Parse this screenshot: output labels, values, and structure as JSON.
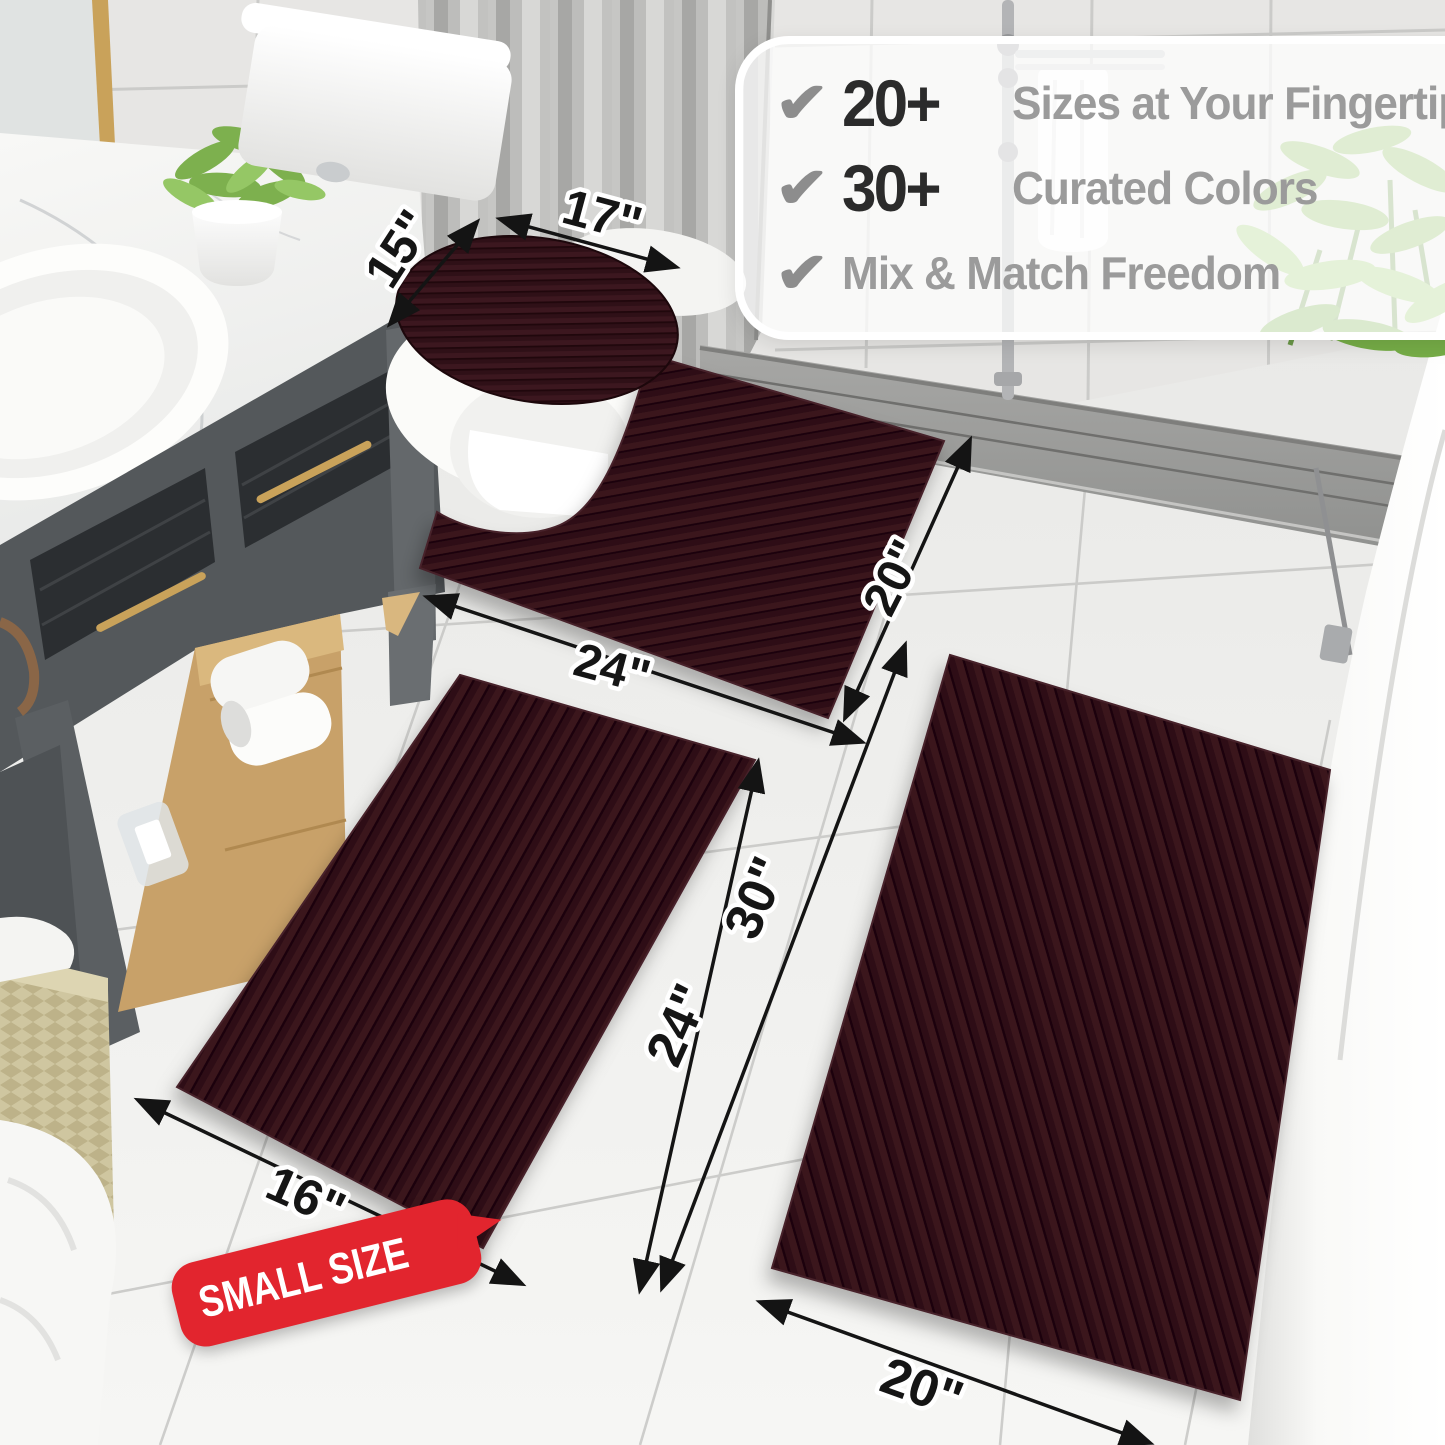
{
  "callout": {
    "items": [
      {
        "icon": "check-icon",
        "glyph": "✔",
        "value": "20+",
        "label": "Sizes at Your Fingertips"
      },
      {
        "icon": "check-icon",
        "glyph": "✔",
        "value": "30+",
        "label": "Curated Colors"
      },
      {
        "icon": "check-icon",
        "glyph": "✔",
        "value": "",
        "label": "Mix & Match Freedom"
      }
    ]
  },
  "dimensions": {
    "lid_cover_width": "17\"",
    "lid_cover_depth": "15\"",
    "contour_rug_width": "24\"",
    "contour_rug_depth": "20\"",
    "large_rug_length": "30\"",
    "small_rug_length": "24\"",
    "small_rug_width": "16\"",
    "large_rug_width": "20\""
  },
  "badge": {
    "label": "SMALL SIZE",
    "color": "#e2252e"
  },
  "colors": {
    "rug_base": "#2d0f16",
    "rug_stripe_light": "#3a151d",
    "rug_stripe_dark": "#1e060b",
    "badge_red": "#e2252e",
    "check_gray": "#8d8d8d",
    "number_dark": "#2b2b2b",
    "label_gray": "#9b9b9b",
    "floor": "#f1f1ef",
    "wall": "#e7e6e4"
  }
}
